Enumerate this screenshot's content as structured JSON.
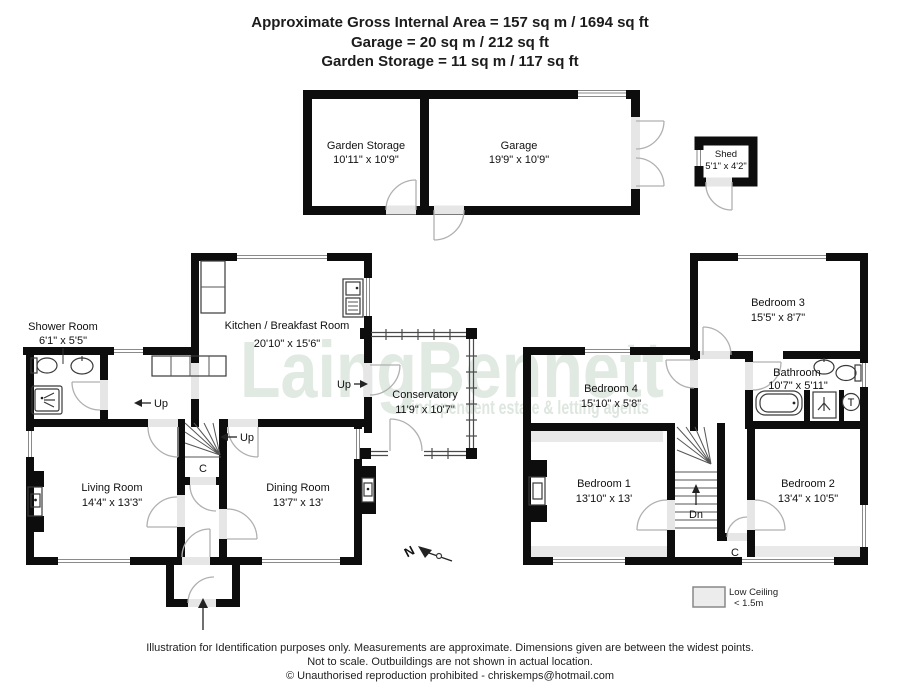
{
  "header": {
    "line1": "Approximate Gross Internal Area  =  157 sq m / 1694 sq ft",
    "line2": "Garage =  20 sq m / 212 sq ft",
    "line3": "Garden Storage = 11 sq m / 117 sq ft"
  },
  "outbuildings": {
    "garden_storage": {
      "name": "Garden Storage",
      "dims": "10'11\" x 10'9\""
    },
    "garage": {
      "name": "Garage",
      "dims": "19'9\" x 10'9\""
    },
    "shed": {
      "name": "Shed",
      "dims": "5'1\" x 4'2\""
    }
  },
  "ground_floor": {
    "kitchen": {
      "name": "Kitchen / Breakfast Room",
      "dims": "20'10\" x 15'6\""
    },
    "shower_room": {
      "name": "Shower Room",
      "dims": "6'1\" x 5'5\""
    },
    "living_room": {
      "name": "Living Room",
      "dims": "14'4\" x 13'3\""
    },
    "dining_room": {
      "name": "Dining Room",
      "dims": "13'7\" x 13'"
    },
    "conservatory": {
      "name": "Conservatory",
      "dims": "11'9\" x 10'7\""
    },
    "up_hall": "Up",
    "up_stairs": "Up",
    "up_conservatory": "Up",
    "cupboard": "C"
  },
  "first_floor": {
    "bedroom1": {
      "name": "Bedroom 1",
      "dims": "13'10\" x 13'"
    },
    "bedroom2": {
      "name": "Bedroom 2",
      "dims": "13'4\" x 10'5\""
    },
    "bedroom3": {
      "name": "Bedroom 3",
      "dims": "15'5\" x 8'7\""
    },
    "bedroom4": {
      "name": "Bedroom 4",
      "dims": "15'10\" x 5'8\""
    },
    "bathroom": {
      "name": "Bathroom",
      "dims": "10'7\" x 5'11\""
    },
    "down": "Dn",
    "cupboard": "C",
    "tank": "T"
  },
  "legend": {
    "title": "Low Ceiling",
    "value": "< 1.5m"
  },
  "compass": {
    "north": "N"
  },
  "watermark": {
    "brand": "LaingBennett",
    "tagline": "independent estate & letting agents"
  },
  "footer": {
    "line1": "Illustration for Identification purposes only.  Measurements are approximate. Dimensions given are between the widest points.",
    "line2": "Not to scale.  Outbuildings are not shown in actual location.",
    "line3": "© Unauthorised reproduction prohibited  -  chriskemps@hotmail.com"
  }
}
